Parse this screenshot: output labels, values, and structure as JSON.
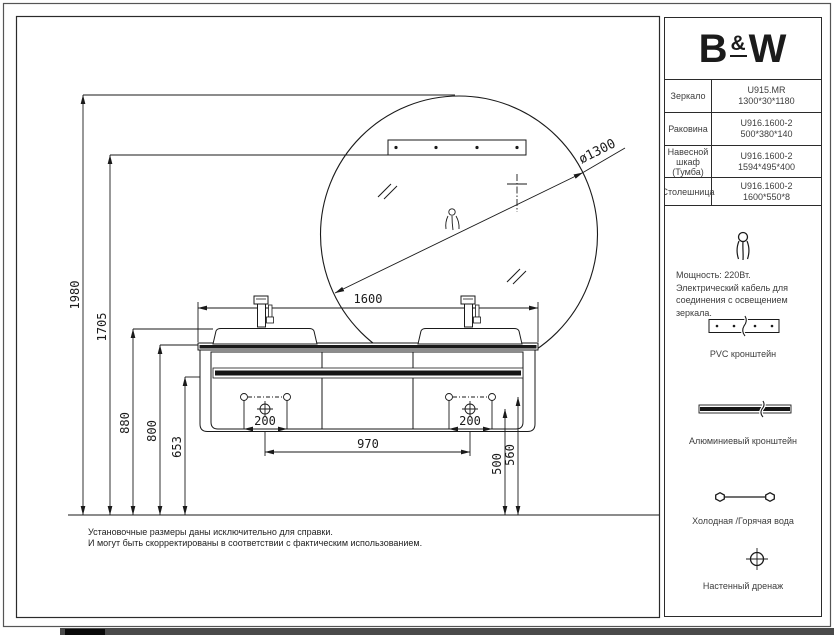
{
  "sidebar": {
    "logo_b": "B",
    "logo_amp": "&",
    "logo_w": "W",
    "table": {
      "rows": [
        {
          "label": "Зеркало",
          "value": "U915.MR\n1300*30*1180"
        },
        {
          "label": "Раковина",
          "value": "U916.1600-2\n500*380*140"
        },
        {
          "label": "Навесной шкаф (Тумба)",
          "value": "U916.1600-2\n1594*495*400"
        },
        {
          "label": "Столешница",
          "value": "U916.1600-2\n1600*550*8"
        }
      ]
    },
    "power_note": "Мощность: 220Вт.\nЭлектрический кабель для\nсоединения с освещением\nзеркала.",
    "pvc_caption": "PVC кронштейн",
    "aluminum_caption": "Алюминиевый кронштейн",
    "water_caption": "Холодная /Горячая вода",
    "drain_caption": "Настенный дренаж"
  },
  "drawing": {
    "dims": {
      "total_height": "1980",
      "bracket_height": "1705",
      "basin_height": "880",
      "countertop_height": "800",
      "bar_height": "653",
      "countertop_width": "1600",
      "drain_spacing": "970",
      "hole_spacing_left": "200",
      "hole_spacing_right": "200",
      "drain_height": "500",
      "hole_height": "560",
      "mirror_diameter": "ø1300"
    },
    "footnote": "Установочные размеры даны исключительно для справки.\nИ могут быть скорректированы в соответствии с фактическим использованием."
  },
  "colors": {
    "line": "#1a1a1a",
    "text": "#3d3d3d"
  }
}
